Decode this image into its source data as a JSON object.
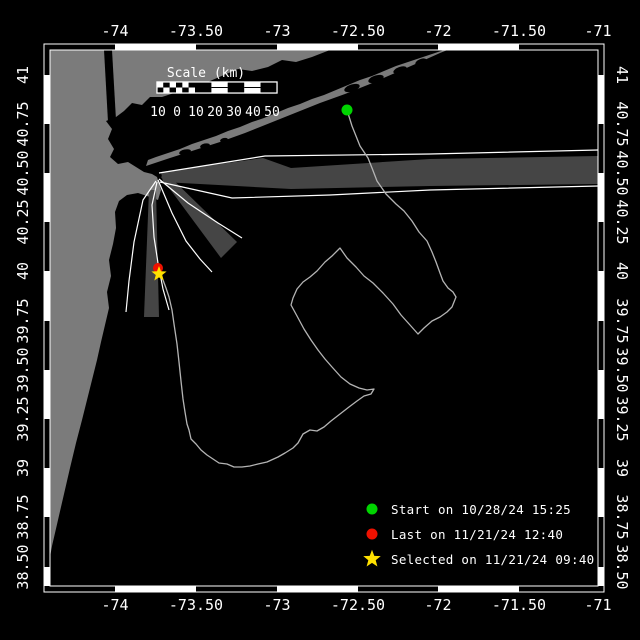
{
  "map": {
    "colors": {
      "background": "#000000",
      "land": "#7b7b7b",
      "water": "#000000",
      "beam_fill": "#454545",
      "beam_line": "#ffffff",
      "track": "#b4b4b4",
      "frame": "#ffffff",
      "text": "#ffffff",
      "start": "#00d400",
      "last": "#ee1100",
      "selected": "#ffe100"
    },
    "frame": {
      "outer": [
        44,
        44,
        560,
        548
      ],
      "inner": [
        50,
        50,
        548,
        536
      ]
    },
    "axes": {
      "lon_ticks": [
        {
          "label": "-74",
          "x": 115
        },
        {
          "label": "-73.50",
          "x": 196
        },
        {
          "label": "-73",
          "x": 277
        },
        {
          "label": "-72.50",
          "x": 358
        },
        {
          "label": "-72",
          "x": 438
        },
        {
          "label": "-71.50",
          "x": 519
        },
        {
          "label": "-71",
          "x": 598
        }
      ],
      "lat_ticks": [
        {
          "label": "41",
          "y": 75
        },
        {
          "label": "40.75",
          "y": 124
        },
        {
          "label": "40.50",
          "y": 173
        },
        {
          "label": "40.25",
          "y": 222
        },
        {
          "label": "40",
          "y": 271
        },
        {
          "label": "39.75",
          "y": 321
        },
        {
          "label": "39.50",
          "y": 370
        },
        {
          "label": "39.25",
          "y": 419
        },
        {
          "label": "39",
          "y": 468
        },
        {
          "label": "38.75",
          "y": 517
        },
        {
          "label": "38.50",
          "y": 567
        }
      ],
      "top_label_y": 36,
      "bottom_label_y": 610,
      "left_label_x": 28,
      "right_label_x": 617
    },
    "scalebar": {
      "title": "Scale (km)",
      "title_x": 206,
      "title_y": 77,
      "bar": [
        157,
        82,
        120,
        11
      ],
      "checker_end_x": 195,
      "labels": [
        {
          "t": "10",
          "x": 158
        },
        {
          "t": "0",
          "x": 177
        },
        {
          "t": "10",
          "x": 196
        },
        {
          "t": "20",
          "x": 215
        },
        {
          "t": "30",
          "x": 234
        },
        {
          "t": "40",
          "x": 253
        },
        {
          "t": "50",
          "x": 272
        }
      ],
      "label_y": 116
    },
    "legend": {
      "marker_x": 372,
      "text_x": 391,
      "start": {
        "label": "Start on 10/28/24 15:25",
        "y": 509
      },
      "last": {
        "label": "Last on 11/21/24 12:40",
        "y": 534
      },
      "selected": {
        "label": "Selected on 11/21/24 09:40",
        "y": 559
      }
    },
    "markers": {
      "start": {
        "x": 347,
        "y": 110
      },
      "last": {
        "x": 158,
        "y": 268
      },
      "selected": {
        "x": 159,
        "y": 274
      }
    },
    "track": [
      [
        347,
        110
      ],
      [
        352,
        126
      ],
      [
        360,
        146
      ],
      [
        368,
        158
      ],
      [
        372,
        168
      ],
      [
        377,
        181
      ],
      [
        386,
        194
      ],
      [
        396,
        204
      ],
      [
        404,
        211
      ],
      [
        412,
        221
      ],
      [
        419,
        232
      ],
      [
        427,
        241
      ],
      [
        432,
        252
      ],
      [
        436,
        262
      ],
      [
        440,
        273
      ],
      [
        443,
        281
      ],
      [
        448,
        288
      ],
      [
        453,
        292
      ],
      [
        456,
        297
      ],
      [
        452,
        307
      ],
      [
        447,
        312
      ],
      [
        440,
        317
      ],
      [
        432,
        321
      ],
      [
        424,
        328
      ],
      [
        418,
        334
      ],
      [
        410,
        325
      ],
      [
        401,
        315
      ],
      [
        393,
        304
      ],
      [
        383,
        293
      ],
      [
        373,
        283
      ],
      [
        364,
        276
      ],
      [
        356,
        267
      ],
      [
        347,
        258
      ],
      [
        340,
        248
      ],
      [
        332,
        256
      ],
      [
        325,
        262
      ],
      [
        317,
        271
      ],
      [
        310,
        277
      ],
      [
        303,
        282
      ],
      [
        297,
        289
      ],
      [
        293,
        298
      ],
      [
        291,
        305
      ],
      [
        297,
        316
      ],
      [
        304,
        329
      ],
      [
        311,
        340
      ],
      [
        318,
        350
      ],
      [
        325,
        359
      ],
      [
        332,
        367
      ],
      [
        341,
        377
      ],
      [
        350,
        384
      ],
      [
        359,
        388
      ],
      [
        367,
        390
      ],
      [
        374,
        389
      ],
      [
        371,
        394
      ],
      [
        364,
        396
      ],
      [
        357,
        401
      ],
      [
        349,
        407
      ],
      [
        340,
        414
      ],
      [
        331,
        421
      ],
      [
        324,
        427
      ],
      [
        317,
        431
      ],
      [
        310,
        430
      ],
      [
        303,
        434
      ],
      [
        298,
        443
      ],
      [
        293,
        448
      ],
      [
        285,
        453
      ],
      [
        278,
        457
      ],
      [
        267,
        462
      ],
      [
        258,
        464
      ],
      [
        250,
        466
      ],
      [
        242,
        467
      ],
      [
        234,
        467
      ],
      [
        227,
        464
      ],
      [
        219,
        463
      ],
      [
        213,
        459
      ],
      [
        207,
        455
      ],
      [
        201,
        450
      ],
      [
        196,
        444
      ],
      [
        191,
        439
      ],
      [
        189,
        430
      ],
      [
        187,
        424
      ],
      [
        185,
        412
      ],
      [
        183,
        399
      ],
      [
        181,
        381
      ],
      [
        179,
        362
      ],
      [
        177,
        344
      ],
      [
        174,
        324
      ],
      [
        172,
        310
      ],
      [
        169,
        297
      ],
      [
        166,
        288
      ],
      [
        163,
        280
      ],
      [
        160,
        273
      ],
      [
        158,
        268
      ]
    ],
    "land": {
      "mainland": [
        [
          50,
          50
        ],
        [
          330,
          50
        ],
        [
          312,
          57
        ],
        [
          296,
          62
        ],
        [
          282,
          60
        ],
        [
          268,
          67
        ],
        [
          252,
          71
        ],
        [
          238,
          69
        ],
        [
          224,
          75
        ],
        [
          210,
          81
        ],
        [
          198,
          87
        ],
        [
          186,
          85
        ],
        [
          174,
          93
        ],
        [
          162,
          97
        ],
        [
          150,
          97
        ],
        [
          142,
          105
        ],
        [
          132,
          103
        ],
        [
          124,
          111
        ],
        [
          116,
          117
        ],
        [
          106,
          121
        ],
        [
          112,
          129
        ],
        [
          108,
          139
        ],
        [
          114,
          149
        ],
        [
          110,
          157
        ],
        [
          118,
          164
        ],
        [
          128,
          162
        ],
        [
          136,
          167
        ],
        [
          144,
          172
        ],
        [
          152,
          174
        ],
        [
          157,
          177
        ],
        [
          161,
          190
        ],
        [
          158,
          200
        ],
        [
          150,
          197
        ],
        [
          138,
          193
        ],
        [
          127,
          195
        ],
        [
          119,
          201
        ],
        [
          115,
          212
        ],
        [
          116,
          228
        ],
        [
          113,
          244
        ],
        [
          109,
          260
        ],
        [
          111,
          276
        ],
        [
          107,
          292
        ],
        [
          109,
          308
        ],
        [
          105,
          325
        ],
        [
          101,
          342
        ],
        [
          97,
          360
        ],
        [
          92,
          380
        ],
        [
          87,
          400
        ],
        [
          82,
          420
        ],
        [
          76,
          443
        ],
        [
          70,
          468
        ],
        [
          64,
          494
        ],
        [
          58,
          520
        ],
        [
          52,
          546
        ],
        [
          50,
          557
        ]
      ],
      "long_island": [
        [
          146,
          166
        ],
        [
          170,
          158
        ],
        [
          195,
          150
        ],
        [
          220,
          142
        ],
        [
          245,
          133
        ],
        [
          270,
          123
        ],
        [
          295,
          113
        ],
        [
          320,
          103
        ],
        [
          345,
          94
        ],
        [
          370,
          84
        ],
        [
          395,
          73
        ],
        [
          420,
          62
        ],
        [
          440,
          53
        ],
        [
          455,
          47
        ],
        [
          468,
          45
        ],
        [
          456,
          46
        ],
        [
          444,
          50
        ],
        [
          432,
          54
        ],
        [
          420,
          58
        ],
        [
          408,
          62
        ],
        [
          396,
          66
        ],
        [
          384,
          71
        ],
        [
          372,
          76
        ],
        [
          360,
          80
        ],
        [
          348,
          85
        ],
        [
          336,
          90
        ],
        [
          324,
          95
        ],
        [
          312,
          99
        ],
        [
          300,
          104
        ],
        [
          288,
          108
        ],
        [
          276,
          113
        ],
        [
          264,
          118
        ],
        [
          252,
          122
        ],
        [
          240,
          127
        ],
        [
          228,
          131
        ],
        [
          216,
          136
        ],
        [
          204,
          140
        ],
        [
          192,
          144
        ],
        [
          180,
          149
        ],
        [
          168,
          153
        ],
        [
          156,
          157
        ],
        [
          148,
          160
        ]
      ],
      "bays": [
        {
          "cx": 352,
          "cy": 88,
          "rx": 8,
          "ry": 3.5,
          "rot": -18
        },
        {
          "cx": 376,
          "cy": 79,
          "rx": 8,
          "ry": 3.5,
          "rot": -18
        },
        {
          "cx": 400,
          "cy": 70,
          "rx": 7,
          "ry": 3,
          "rot": -20
        },
        {
          "cx": 421,
          "cy": 62,
          "rx": 6,
          "ry": 3,
          "rot": -22
        },
        {
          "cx": 185,
          "cy": 152,
          "rx": 6,
          "ry": 2.5,
          "rot": -12
        },
        {
          "cx": 205,
          "cy": 146,
          "rx": 5,
          "ry": 2.5,
          "rot": -12
        },
        {
          "cx": 224,
          "cy": 140,
          "rx": 4,
          "ry": 2,
          "rot": -12
        }
      ],
      "hudson": [
        [
          104,
          50
        ],
        [
          112,
          50
        ],
        [
          116,
          120
        ],
        [
          108,
          122
        ]
      ]
    },
    "beams": {
      "origin": {
        "x": 158,
        "y": 177
      },
      "gray": [
        [
          [
            161,
            172
          ],
          [
            263,
            158
          ],
          [
            291,
            168
          ],
          [
            430,
            159
          ],
          [
            598,
            156
          ],
          [
            598,
            184
          ],
          [
            430,
            186
          ],
          [
            291,
            189
          ],
          [
            163,
            182
          ]
        ],
        [
          [
            161,
            177
          ],
          [
            166,
            173
          ],
          [
            237,
            242
          ],
          [
            221,
            258
          ]
        ],
        [
          [
            149,
            190
          ],
          [
            156,
            190
          ],
          [
            159,
            317
          ],
          [
            144,
            317
          ]
        ]
      ],
      "white": [
        [
          [
            159,
            173
          ],
          [
            265,
            156
          ],
          [
            430,
            154
          ],
          [
            598,
            150
          ]
        ],
        [
          [
            160,
            182
          ],
          [
            232,
            198
          ],
          [
            330,
            195
          ],
          [
            430,
            190
          ],
          [
            598,
            186
          ]
        ],
        [
          [
            159,
            179
          ],
          [
            188,
            203
          ],
          [
            218,
            223
          ],
          [
            242,
            238
          ]
        ],
        [
          [
            158,
            180
          ],
          [
            172,
            213
          ],
          [
            186,
            241
          ],
          [
            200,
            259
          ],
          [
            212,
            272
          ]
        ],
        [
          [
            156,
            181
          ],
          [
            143,
            200
          ],
          [
            134,
            242
          ],
          [
            129,
            281
          ],
          [
            126,
            312
          ]
        ],
        [
          [
            157,
            182
          ],
          [
            152,
            205
          ],
          [
            154,
            237
          ],
          [
            158,
            263
          ],
          [
            163,
            289
          ],
          [
            169,
            310
          ]
        ]
      ]
    }
  }
}
